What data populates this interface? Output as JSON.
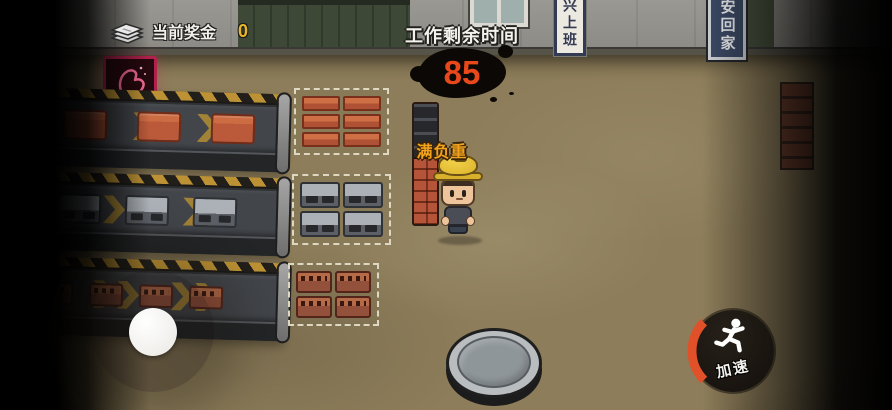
{
  "hud": {
    "bonus_label": "当前奖金",
    "bonus_value": "0",
    "timer_label": "工作剩余时间",
    "timer_value": "85",
    "speed_button_label": "加速"
  },
  "signs": {
    "left_sign": "兴上班",
    "right_sign": "安回家"
  },
  "player": {
    "load_label": "满负重"
  },
  "belts": [
    {
      "name": "red-brick-belt",
      "item": "red-brick",
      "count": 4
    },
    {
      "name": "gray-block-belt",
      "item": "gray-block",
      "count": 4
    },
    {
      "name": "small-brick-belt",
      "item": "small-brick",
      "count": 5
    }
  ],
  "drop_zones": [
    {
      "name": "red-brick-zone",
      "item": "red-brick-slab",
      "rows": 3,
      "cols": 2
    },
    {
      "name": "gray-block-zone",
      "item": "gray-block",
      "rows": 2,
      "cols": 2
    },
    {
      "name": "small-brick-zone",
      "item": "small-brick",
      "rows": 2,
      "cols": 2
    }
  ],
  "icons": {
    "bonus": "banknote-stack-icon",
    "speed": "running-man-icon",
    "strength_sign": "flexed-arm-icon",
    "belt_direction": "chevron-right-icon"
  },
  "colors": {
    "bonus_value": "#e7b62a",
    "timer_value": "#e8481a",
    "load_label": "#f2a31d",
    "speed_arc": "#e0512a",
    "chevron_gold": "#b38d33",
    "ground": "#8d7d5a",
    "belt": "#42454a",
    "red_brick": "#bb5a3a",
    "gray_block": "#9aa0a8",
    "sign_navy": "#3c4a66"
  }
}
